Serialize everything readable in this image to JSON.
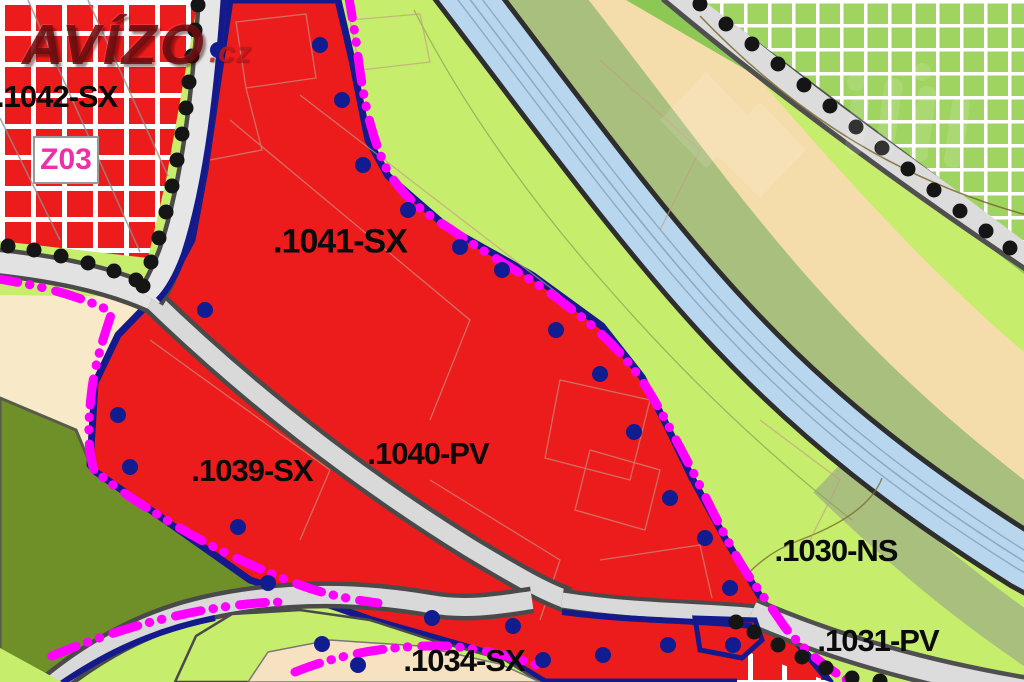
{
  "map": {
    "watermark_main": {
      "text": "AVÍZO",
      "suffix": ".cz"
    },
    "change_code_box": {
      "text": "Z03"
    },
    "zone_labels": [
      {
        "id": "1042",
        "text": ".1042-SX"
      },
      {
        "id": "1041",
        "text": ".1041-SX"
      },
      {
        "id": "1040",
        "text": ".1040-PV"
      },
      {
        "id": "1039",
        "text": ".1039-SX"
      },
      {
        "id": "1034",
        "text": ".1034-SX"
      },
      {
        "id": "1030",
        "text": ".1030-NS"
      },
      {
        "id": "1031",
        "text": ".1031-PV"
      }
    ],
    "colors": {
      "zone_red": "#ed1c1c",
      "zone_green_light": "#c6ed6b",
      "zone_green_hatch": "#9ed45f",
      "zone_green_medium": "#8cc853",
      "zone_sage_band": "#a9bf7d",
      "zone_olive": "#6f8f28",
      "zone_cream": "#f8e9c8",
      "zone_tan_band": "#f5dcab",
      "water_blue": "#b8d7ee",
      "boundary_navy": "#141a8c",
      "boundary_magenta": "#ff00ff",
      "road_fill": "#dcdcdc",
      "road_edge": "#4f4f4f",
      "marker_dot_black": "#151515"
    }
  }
}
